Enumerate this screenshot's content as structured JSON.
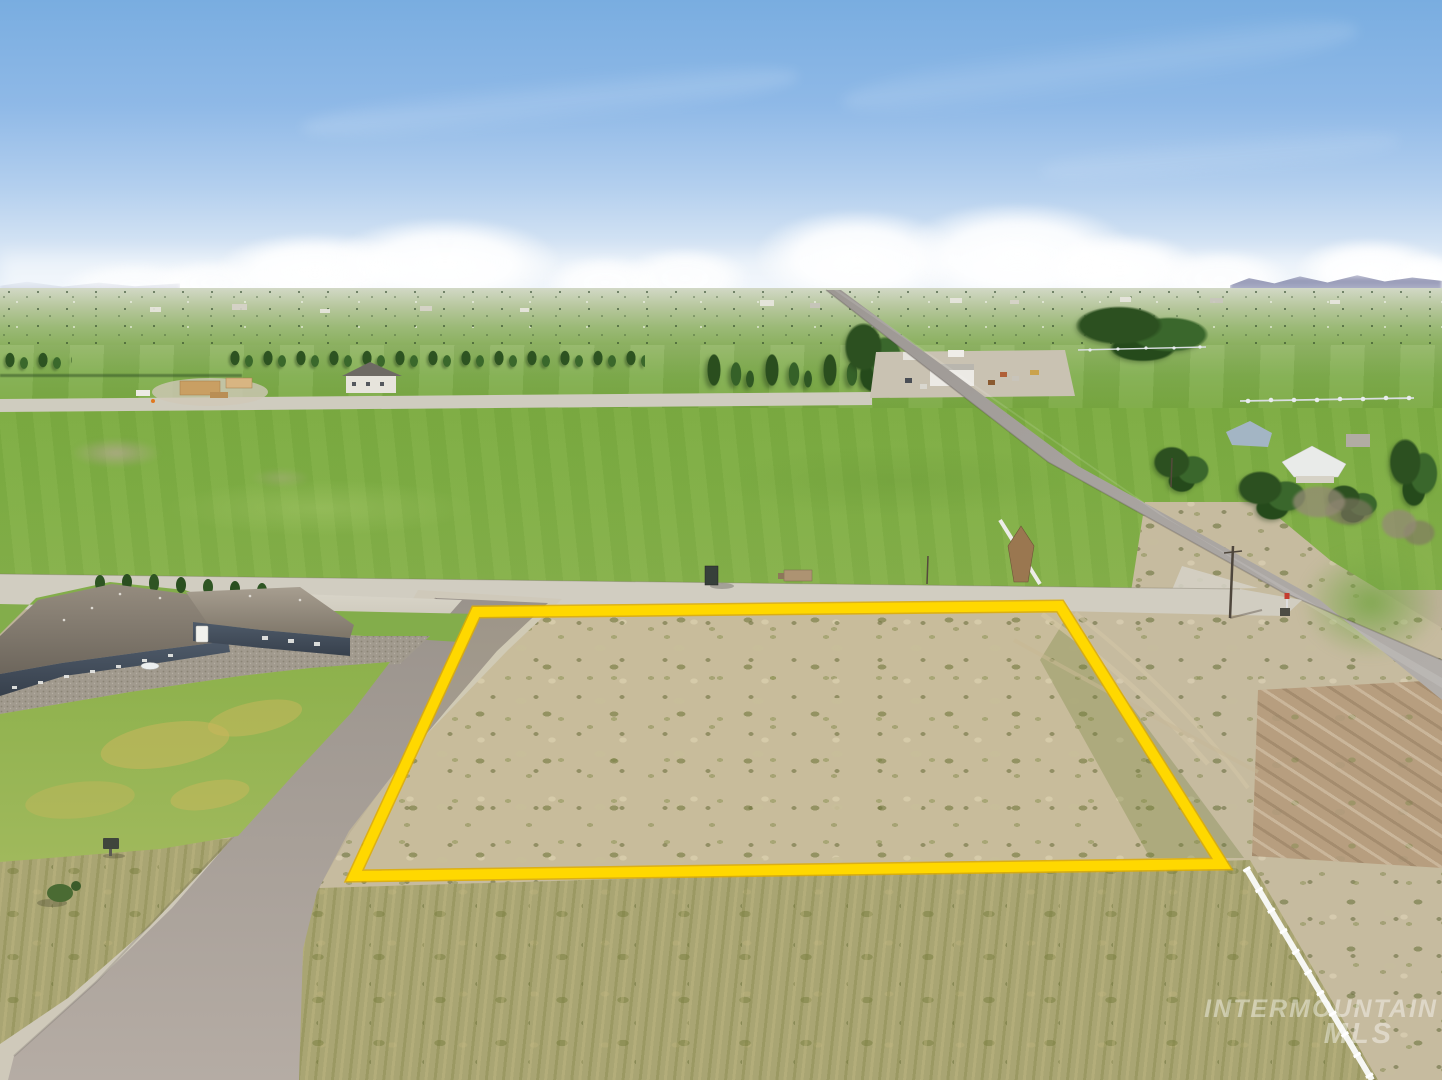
{
  "meta": {
    "description": "Aerial drone photograph of a vacant dirt lot outlined in yellow at a rural road intersection, surrounded by green farm fields, a blue single-story house, country roads and a blue sky with scattered clouds.",
    "photo_type": "real estate aerial listing photo",
    "width_px": 1442,
    "height_px": 1080
  },
  "watermark": {
    "line1": "INTERMOUNTAIN",
    "line2": "MLS",
    "color": "#ffffff",
    "opacity": 0.42
  },
  "scene_colors": {
    "sky_top": "#79ade0",
    "sky_horizon": "#e9f1f9",
    "cloud_white": "#ffffff",
    "hills_blue": "#9094b4",
    "far_field_green": "#8cb068",
    "field_green": "#7cab41",
    "lawn_green": "#93b352",
    "lawn_dry": "#cbb75c",
    "tree_dark": "#2c5020",
    "tree_mid": "#3a672c",
    "scrub_tan": "#c6bb9f",
    "scrub_olive": "#8d9355",
    "foreground_olive": "#a9a573",
    "dirt_brown": "#b79e7f",
    "gravel_light": "#d1cdc1",
    "asphalt": "#a29a93",
    "paved_road": "#a8a49e",
    "roof_gray": "#847c70",
    "siding_navy": "#414c5a",
    "door_white": "#f1f1ed",
    "fence_white": "#f6f7f3",
    "lot_outline_yellow": "#ffd800"
  },
  "scene_elements": [
    {
      "name": "highlighted-lot",
      "description": "Vacant scrub lot outlined with thick yellow boundary lines"
    },
    {
      "name": "blue-house",
      "description": "Single-story blue-gray house with hip roof at left"
    },
    {
      "name": "subdivision-road",
      "description": "Asphalt road curving along the left side of the lot"
    },
    {
      "name": "gravel-road",
      "description": "Light gravel road running along the top of the lot"
    },
    {
      "name": "paved-road",
      "description": "Two-lane rural road running diagonally on the right"
    },
    {
      "name": "white-vinyl-fence",
      "description": "White fence along the lower right edge of the lot"
    },
    {
      "name": "farm-fields",
      "description": "Green irrigated pastures and farmland in the background"
    },
    {
      "name": "farm-compound",
      "description": "Farmyard with white outbuildings and equipment"
    },
    {
      "name": "construction-site",
      "description": "House under construction in the left background"
    },
    {
      "name": "neighbor-houses",
      "description": "Houses among trees on the right side"
    },
    {
      "name": "sky",
      "description": "Blue sky with scattered cumulus clouds over distant hills"
    }
  ]
}
